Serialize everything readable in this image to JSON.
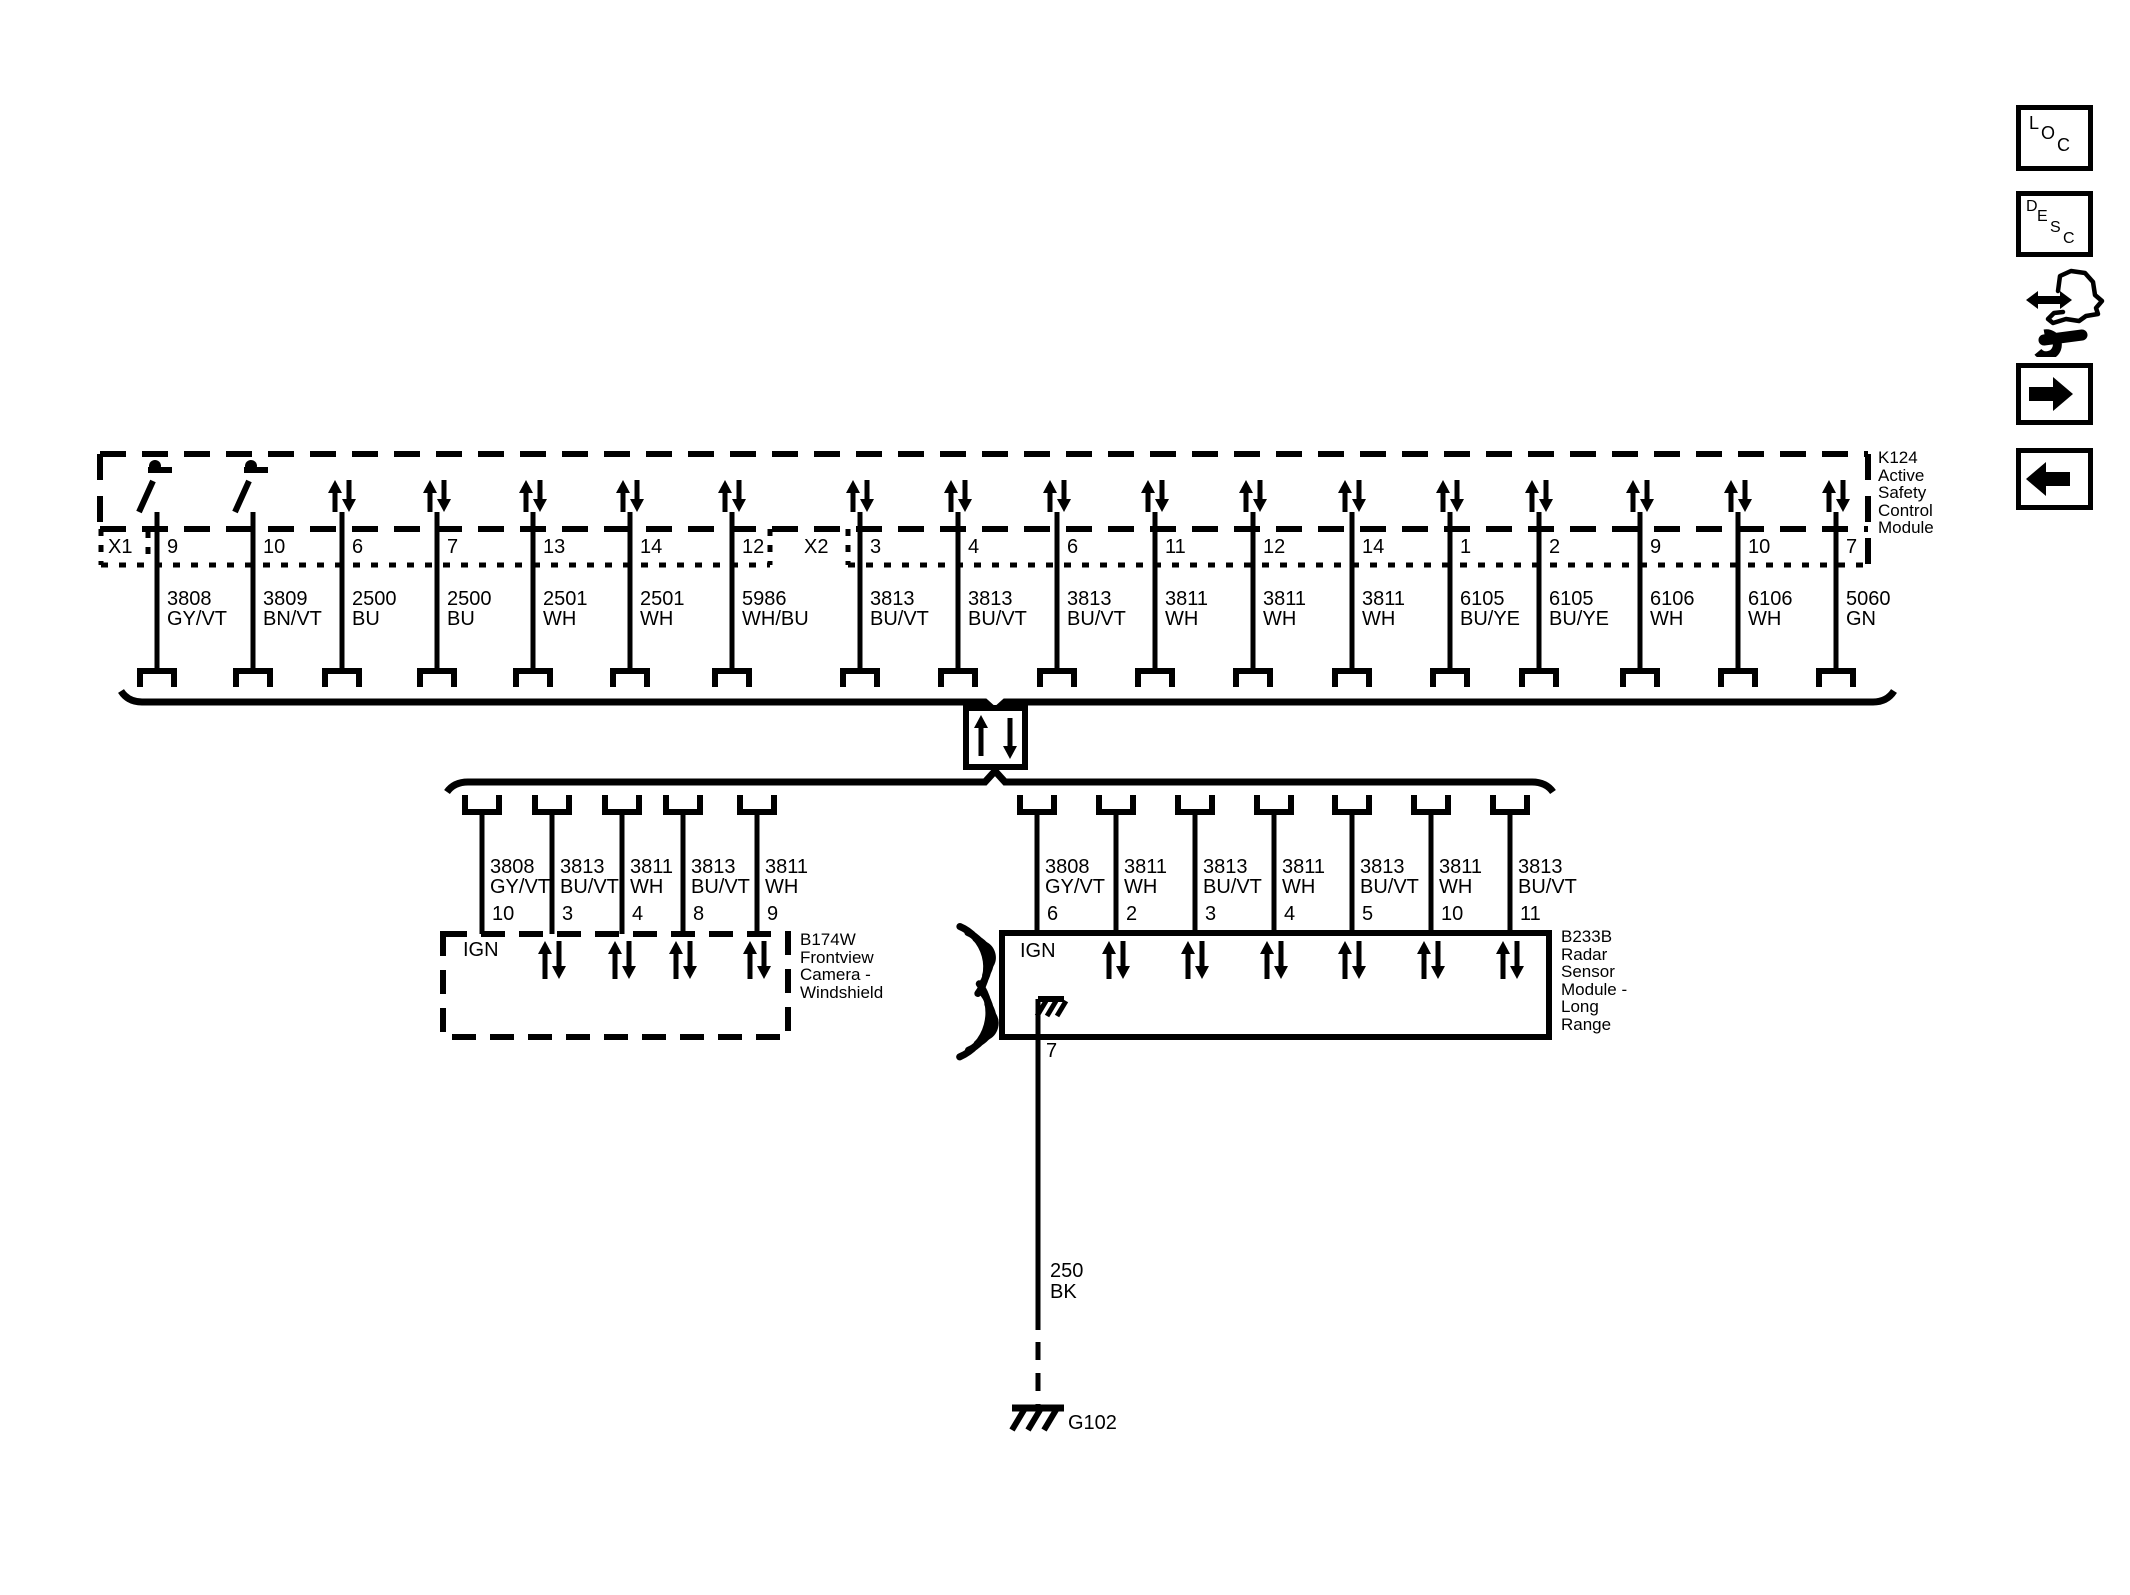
{
  "k124": {
    "label_lines": [
      "K124",
      "Active",
      "Safety",
      "Control",
      "Module"
    ],
    "connector_x1": {
      "label": "X1",
      "pins": [
        {
          "pin": "9",
          "circuit": "3808",
          "color": "GY/VT",
          "symbol": "switch"
        },
        {
          "pin": "10",
          "circuit": "3809",
          "color": "BN/VT",
          "symbol": "switch"
        },
        {
          "pin": "6",
          "circuit": "2500",
          "color": "BU",
          "symbol": "bidir"
        },
        {
          "pin": "7",
          "circuit": "2500",
          "color": "BU",
          "symbol": "bidir"
        },
        {
          "pin": "13",
          "circuit": "2501",
          "color": "WH",
          "symbol": "bidir"
        },
        {
          "pin": "14",
          "circuit": "2501",
          "color": "WH",
          "symbol": "bidir"
        },
        {
          "pin": "12",
          "circuit": "5986",
          "color": "WH/BU",
          "symbol": "bidir"
        }
      ]
    },
    "connector_x2": {
      "label": "X2",
      "pins": [
        {
          "pin": "3",
          "circuit": "3813",
          "color": "BU/VT",
          "symbol": "bidir"
        },
        {
          "pin": "4",
          "circuit": "3813",
          "color": "BU/VT",
          "symbol": "bidir"
        },
        {
          "pin": "6",
          "circuit": "3813",
          "color": "BU/VT",
          "symbol": "bidir"
        },
        {
          "pin": "11",
          "circuit": "3811",
          "color": "WH",
          "symbol": "bidir"
        },
        {
          "pin": "12",
          "circuit": "3811",
          "color": "WH",
          "symbol": "bidir"
        },
        {
          "pin": "14",
          "circuit": "3811",
          "color": "WH",
          "symbol": "bidir"
        },
        {
          "pin": "1",
          "circuit": "6105",
          "color": "BU/YE",
          "symbol": "bidir"
        },
        {
          "pin": "2",
          "circuit": "6105",
          "color": "BU/YE",
          "symbol": "bidir"
        },
        {
          "pin": "9",
          "circuit": "6106",
          "color": "WH",
          "symbol": "bidir"
        },
        {
          "pin": "10",
          "circuit": "6106",
          "color": "WH",
          "symbol": "bidir"
        },
        {
          "pin": "7",
          "circuit": "5060",
          "color": "GN",
          "symbol": "bidir"
        }
      ]
    }
  },
  "camera": {
    "label_lines": [
      "B174W",
      "Frontview",
      "Camera -",
      "Windshield"
    ],
    "ign_label": "IGN",
    "pins": [
      {
        "pin": "10",
        "circuit": "3808",
        "color": "GY/VT",
        "symbol": "ign"
      },
      {
        "pin": "3",
        "circuit": "3813",
        "color": "BU/VT",
        "symbol": "bidir"
      },
      {
        "pin": "4",
        "circuit": "3811",
        "color": "WH",
        "symbol": "bidir"
      },
      {
        "pin": "8",
        "circuit": "3813",
        "color": "BU/VT",
        "symbol": "bidir"
      },
      {
        "pin": "9",
        "circuit": "3811",
        "color": "WH",
        "symbol": "bidir"
      }
    ]
  },
  "radar": {
    "label_lines": [
      "B233B",
      "Radar",
      "Sensor",
      "Module -",
      "Long",
      "Range"
    ],
    "ign_label": "IGN",
    "ground_pin": "7",
    "pins": [
      {
        "pin": "6",
        "circuit": "3808",
        "color": "GY/VT",
        "symbol": "ign"
      },
      {
        "pin": "2",
        "circuit": "3811",
        "color": "WH",
        "symbol": "bidir"
      },
      {
        "pin": "3",
        "circuit": "3813",
        "color": "BU/VT",
        "symbol": "bidir"
      },
      {
        "pin": "4",
        "circuit": "3811",
        "color": "WH",
        "symbol": "bidir"
      },
      {
        "pin": "5",
        "circuit": "3813",
        "color": "BU/VT",
        "symbol": "bidir"
      },
      {
        "pin": "10",
        "circuit": "3811",
        "color": "WH",
        "symbol": "bidir"
      },
      {
        "pin": "11",
        "circuit": "3813",
        "color": "BU/VT",
        "symbol": "bidir"
      }
    ]
  },
  "ground_wire": {
    "circuit": "250",
    "color": "BK",
    "ground_label": "G102"
  },
  "toolbar": {
    "loc_label": "LOC",
    "desc_label": "DESC"
  },
  "colors": {
    "ink": "#000000",
    "paper": "#ffffff"
  }
}
